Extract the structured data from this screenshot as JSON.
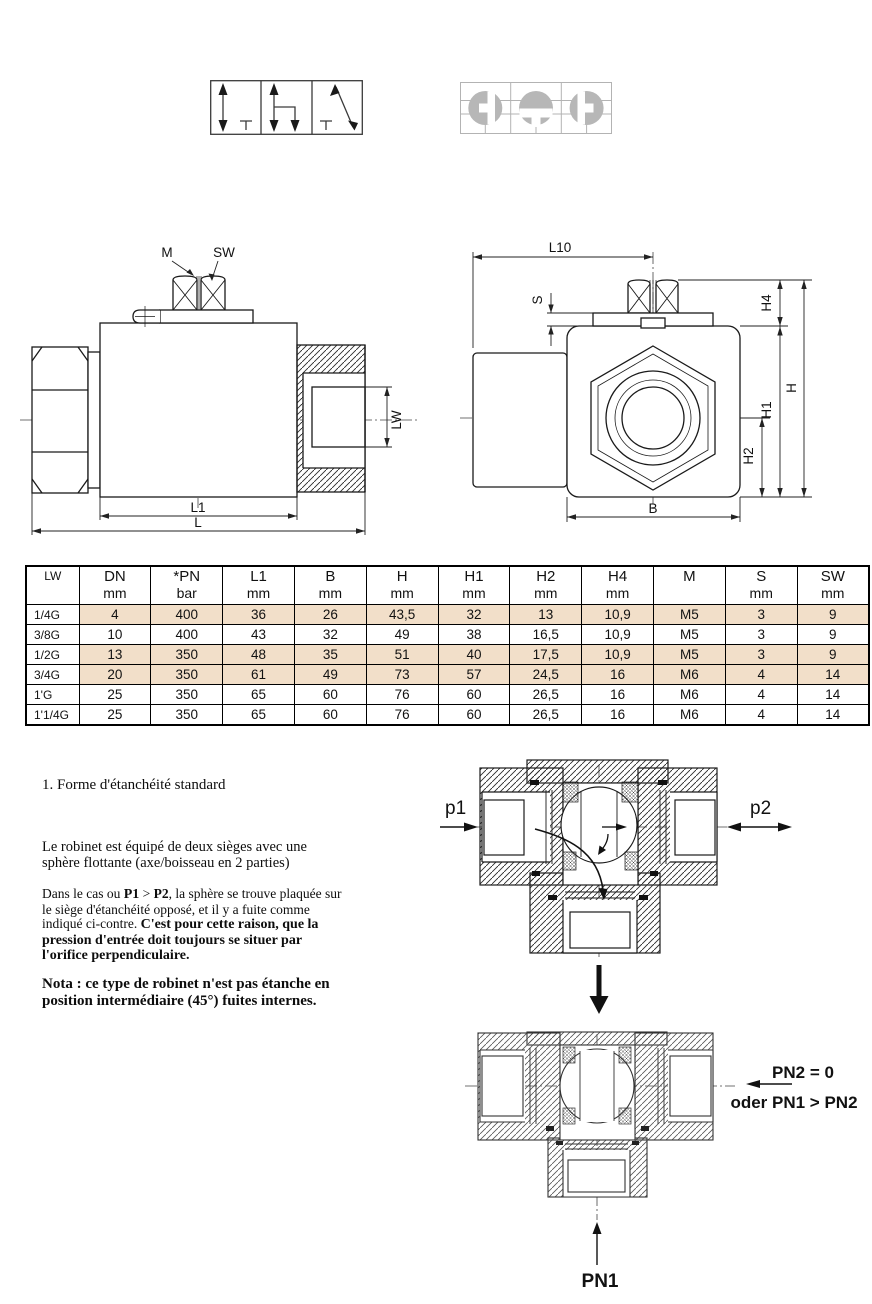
{
  "symbols": {
    "directional_valve": "3-way directional valve symbol",
    "ball_positions": "ball bore position symbol"
  },
  "side_view": {
    "labels": {
      "m": "M",
      "sw": "SW",
      "lw": "LW",
      "l1": "L1",
      "l": "L"
    }
  },
  "end_view": {
    "labels": {
      "l10": "L10",
      "s": "S",
      "h4": "H4",
      "h": "H",
      "h1": "H1",
      "h2": "H2",
      "b": "B"
    }
  },
  "table": {
    "highlight_color": "#f2dfc9",
    "headers": [
      {
        "line1": "LW",
        "line2": ""
      },
      {
        "line1": "DN",
        "line2": "mm"
      },
      {
        "line1": "*PN",
        "line2": "bar"
      },
      {
        "line1": "L1",
        "line2": "mm"
      },
      {
        "line1": "B",
        "line2": "mm"
      },
      {
        "line1": "H",
        "line2": "mm"
      },
      {
        "line1": "H1",
        "line2": "mm"
      },
      {
        "line1": "H2",
        "line2": "mm"
      },
      {
        "line1": "H4",
        "line2": "mm"
      },
      {
        "line1": "M",
        "line2": ""
      },
      {
        "line1": "S",
        "line2": "mm"
      },
      {
        "line1": "SW",
        "line2": "mm"
      }
    ],
    "rows": [
      {
        "lw": "1/4G",
        "values": [
          "4",
          "400",
          "36",
          "26",
          "43,5",
          "32",
          "13",
          "10,9",
          "M5",
          "3",
          "9"
        ]
      },
      {
        "lw": "3/8G",
        "values": [
          "10",
          "400",
          "43",
          "32",
          "49",
          "38",
          "16,5",
          "10,9",
          "M5",
          "3",
          "9"
        ]
      },
      {
        "lw": "1/2G",
        "values": [
          "13",
          "350",
          "48",
          "35",
          "51",
          "40",
          "17,5",
          "10,9",
          "M5",
          "3",
          "9"
        ]
      },
      {
        "lw": "3/4G",
        "values": [
          "20",
          "350",
          "61",
          "49",
          "73",
          "57",
          "24,5",
          "16",
          "M6",
          "4",
          "14"
        ]
      },
      {
        "lw": "1'G",
        "values": [
          "25",
          "350",
          "65",
          "60",
          "76",
          "60",
          "26,5",
          "16",
          "M6",
          "4",
          "14"
        ]
      },
      {
        "lw": "1'1/4G",
        "values": [
          "25",
          "350",
          "65",
          "60",
          "76",
          "60",
          "26,5",
          "16",
          "M6",
          "4",
          "14"
        ]
      }
    ]
  },
  "notes": {
    "heading": "1. Forme d'étanchéité standard",
    "para1": "Le robinet est équipé de deux sièges avec une sphère flottante (axe/boisseau en 2 parties)",
    "para2_seg1": "Dans le cas ou ",
    "para2_bold1": "P1",
    "para2_seg2": " >  ",
    "para2_bold2": "P2",
    "para2_seg3": ", la sphère se trouve plaquée sur le siège d'étanchéité opposé, et il y a fuite comme indiqué ci-contre. ",
    "para2_bold3": "C'est pour cette raison, que la pression d'entrée doit toujours se situer par l'orifice perpendiculaire.",
    "nota": "Nota : ce type de robinet n'est pas étanche en position intermédiaire (45°) fuites internes."
  },
  "flow_diagram": {
    "p1": "p1",
    "p2": "p2"
  },
  "pressure_diagram": {
    "pn2": "PN2 = 0",
    "oder": "oder PN1 > PN2",
    "pn1": "PN1"
  }
}
